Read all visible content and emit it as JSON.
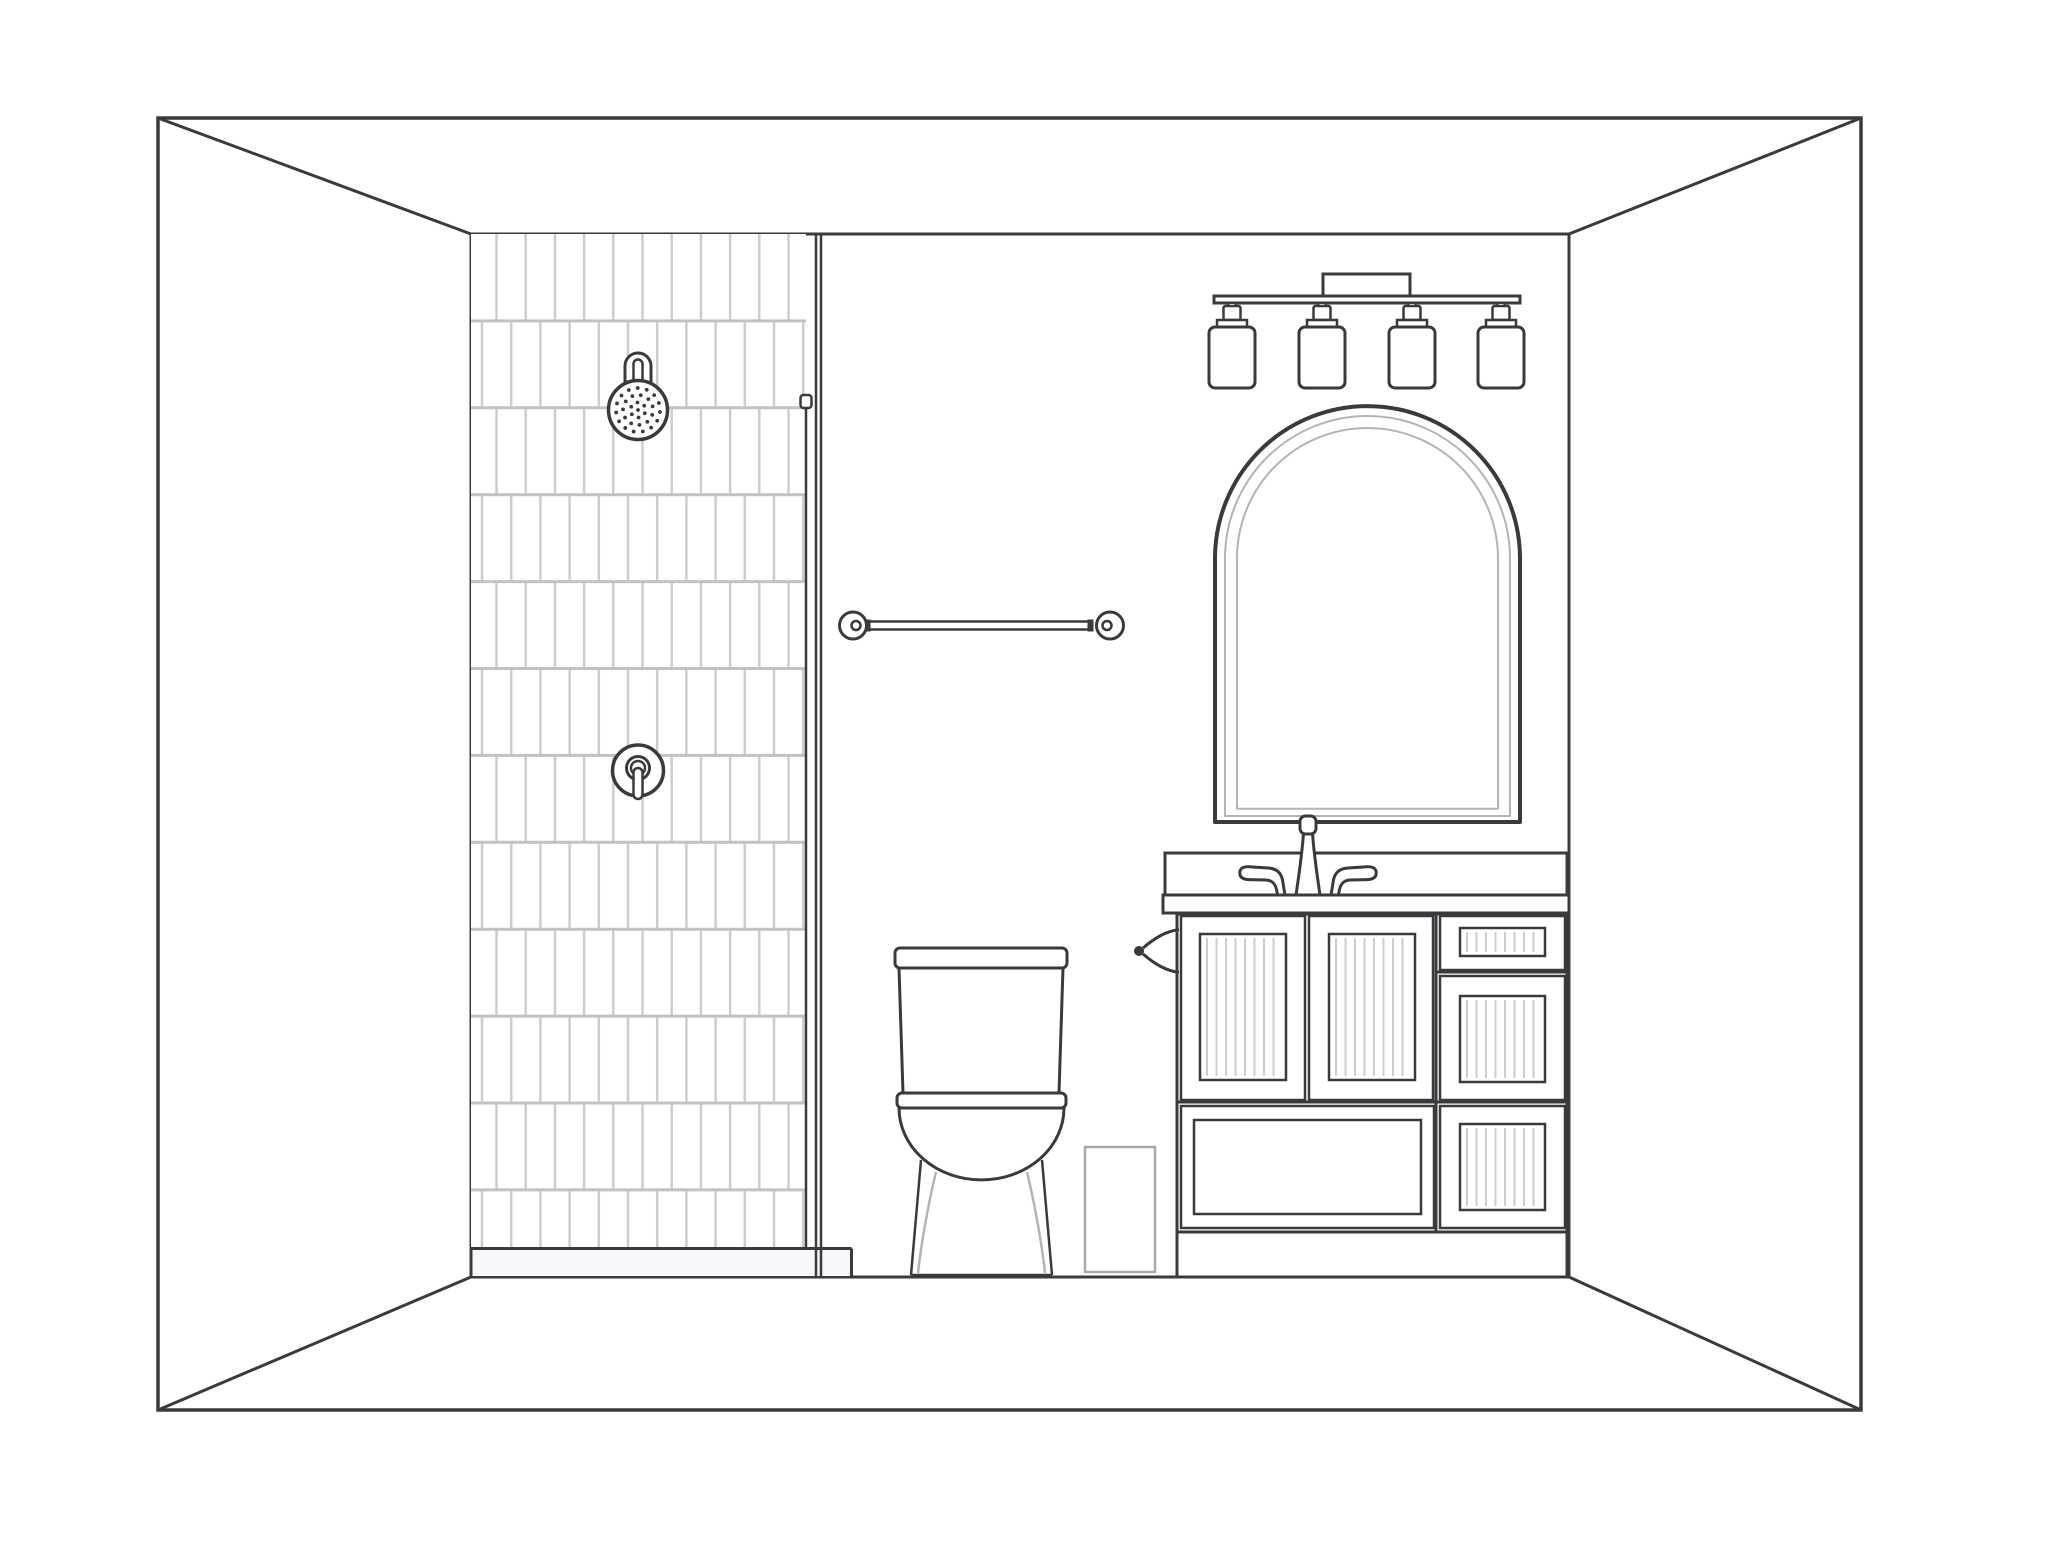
{
  "title": "Bathroom interior line drawing",
  "palette": {
    "ink": "#3a3a3e",
    "grout_vertical": "#cdcdd1",
    "grout_horizontal": "#c2c2c6",
    "soft_gray": "#b4b4b8",
    "bin_gray": "#a9a9ad",
    "pan_tint": "#f6f8fa",
    "white": "#ffffff",
    "background": "#ffffff"
  },
  "scene": {
    "canvas": {
      "width": 2048,
      "height": 1545
    },
    "room": {
      "outer": {
        "x1": 158,
        "y1": 118,
        "x2": 1861,
        "y2": 1410
      },
      "inner": {
        "x1": 471,
        "y1": 234,
        "x2": 1569,
        "y2": 1277
      }
    },
    "shower": {
      "tiles": {
        "x1": 471,
        "y1": 234,
        "x2": 806,
        "y2": 1248,
        "col_pitch": 29.2,
        "row_pitch": 86.9,
        "offset_even": 25.5,
        "offset_odd": 11
      },
      "glass": {
        "outer_x1": 816,
        "outer_x2": 821,
        "inner_x": 806,
        "inner_y1": 404,
        "inner_y2": 1248,
        "cap": {
          "x": 800.5,
          "y": 395,
          "w": 11,
          "h": 13
        }
      },
      "pan": {
        "x1": 471,
        "y1": 1248.5,
        "x2": 851.5,
        "y2": 1277
      },
      "head": {
        "cx": 638,
        "cy": 410,
        "r": 29.5,
        "arm": {
          "half_w": 13,
          "slot_half_w": 4.5,
          "top_y": 366,
          "slot_top_y": 364,
          "base_y": 384
        },
        "dot_rings": [
          [
            0,
            1
          ],
          [
            7.5,
            6
          ],
          [
            15,
            11
          ],
          [
            22,
            15
          ]
        ],
        "dot_r": 1.9
      },
      "valve": {
        "cx": 638,
        "cy": 770.5,
        "r_escutcheon": 25.5,
        "ring_cy": 768,
        "r_mid": 11.5,
        "r_hub": 7,
        "lever": {
          "x": 633.5,
          "y": 768,
          "w": 9,
          "h": 31
        }
      }
    },
    "towel_bar": {
      "cy": 625.5,
      "left_cx": 853,
      "right_cx": 1110,
      "knob_r": 13.5,
      "inner_r": 4.5,
      "bar_x1": 866,
      "bar_x2": 1092,
      "bar_y": 621.5,
      "bar_h": 8
    },
    "toilet": {
      "lid": {
        "x": 895,
        "y": 948,
        "w": 172,
        "h": 20,
        "rx": 5
      },
      "tank": {
        "top_x1": 899,
        "top_x2": 1063,
        "bot_x1": 903,
        "bot_x2": 1059,
        "y1": 968,
        "y2": 1093
      },
      "seat": {
        "x": 897,
        "y": 1093,
        "w": 169,
        "h": 15,
        "rx": 5
      },
      "bowl": {
        "x1": 899,
        "x2": 1064,
        "y": 1108,
        "rx": 82.5,
        "ry": 72
      },
      "base": {
        "left_top": [
          921,
          1160
        ],
        "left_bot": [
          911,
          1275
        ],
        "right_top": [
          1042,
          1160
        ],
        "right_bot": [
          1052,
          1275
        ]
      },
      "skirt_left": [
        [
          936,
          1172
        ],
        [
          928,
          1205
        ],
        [
          921,
          1245
        ],
        [
          918,
          1273
        ]
      ],
      "skirt_right": [
        [
          1027,
          1172
        ],
        [
          1035,
          1205
        ],
        [
          1042,
          1245
        ],
        [
          1045,
          1273
        ]
      ]
    },
    "trash_bin": {
      "x": 1085,
      "y": 1147,
      "w": 70,
      "h": 125
    },
    "vanity": {
      "backsplash": {
        "x": 1165,
        "y": 853,
        "w": 402,
        "h": 42
      },
      "slab": {
        "x": 1163,
        "y": 895,
        "w": 406,
        "h": 18
      },
      "cabinet": {
        "x": 1177,
        "y": 914,
        "w": 390,
        "h": 363,
        "kick_y": 1232,
        "divider_x": 1436,
        "left_divider_y": 1102,
        "right_divider_y1": 972,
        "right_divider_y2": 1102
      },
      "doors": [
        {
          "x": 1181,
          "y": 916,
          "w": 124,
          "h": 184,
          "panel": {
            "x": 1200,
            "y": 934,
            "w": 86,
            "h": 146,
            "striped": true
          }
        },
        {
          "x": 1309,
          "y": 916,
          "w": 124,
          "h": 184,
          "panel": {
            "x": 1329,
            "y": 934,
            "w": 86,
            "h": 146,
            "striped": true
          }
        }
      ],
      "wide_drawer": {
        "x": 1181,
        "y": 1106,
        "w": 253,
        "h": 122,
        "panel": {
          "x": 1194,
          "y": 1120,
          "w": 227,
          "h": 94,
          "striped": false
        }
      },
      "right_drawers": [
        {
          "x": 1440,
          "y": 916,
          "w": 125,
          "h": 54,
          "panel": {
            "x": 1460,
            "y": 928,
            "w": 85,
            "h": 28,
            "striped": true
          }
        },
        {
          "x": 1440,
          "y": 976,
          "w": 125,
          "h": 124,
          "panel": {
            "x": 1460,
            "y": 996,
            "w": 85,
            "h": 86,
            "striped": true
          }
        },
        {
          "x": 1440,
          "y": 1106,
          "w": 125,
          "h": 122,
          "panel": {
            "x": 1460,
            "y": 1124,
            "w": 85,
            "h": 86,
            "striped": true
          }
        }
      ],
      "stripe_pitch": 9.5
    },
    "mirror": {
      "x1": 1215,
      "x2": 1520,
      "top_y": 406,
      "bottom_y": 822,
      "insets": [
        10,
        22
      ]
    },
    "light": {
      "plate": {
        "x": 1323,
        "y": 274,
        "w": 87,
        "h": 22
      },
      "bar": {
        "x": 1214,
        "y": 296,
        "w": 306,
        "h": 7
      },
      "lamp_centers": [
        1232,
        1322,
        1412,
        1501
      ],
      "lamp": {
        "stem_y": 303,
        "stem_h": 5,
        "cap1": {
          "w": 17,
          "h": 14,
          "y": 306
        },
        "cap2": {
          "w": 30,
          "h": 7,
          "y": 320
        },
        "cyl": {
          "w": 46,
          "h": 61,
          "y": 327,
          "rx": 6
        }
      }
    },
    "faucet": {
      "cx": 1308,
      "base_y": 895,
      "base_half_w": 12,
      "neck_half_w": 4.5,
      "neck_top_y": 833,
      "tip": {
        "x": 1300,
        "y": 816,
        "w": 16,
        "h": 18,
        "rx": 5.5
      },
      "handle_mirror_x": 1308
    },
    "hook": {
      "cx": 1139,
      "cy": 951,
      "r": 5,
      "arm_x2": 1179,
      "arm_top_y": 929.5,
      "arm_bot_y": 972.5
    }
  }
}
